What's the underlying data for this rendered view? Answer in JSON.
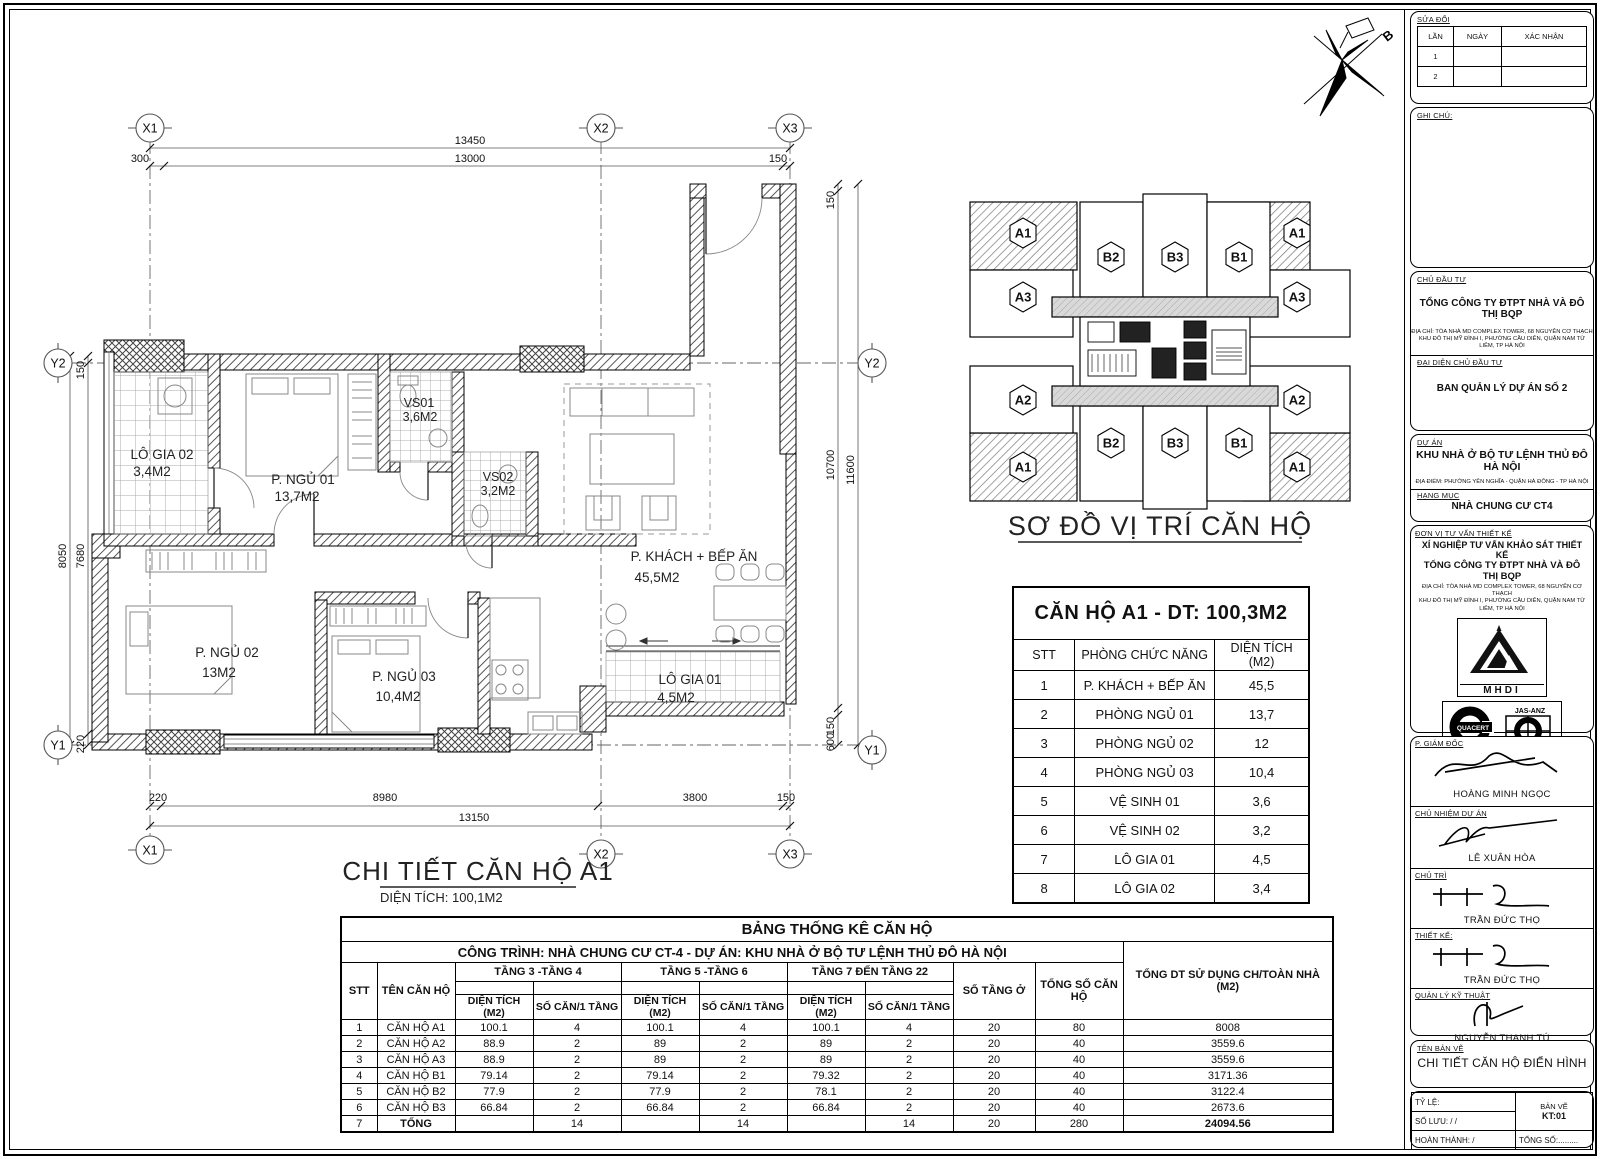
{
  "north_arrow": {
    "label": "B"
  },
  "plan": {
    "title": "CHI TIẾT CĂN HỘ A1",
    "subtitle": "DIỆN TÍCH: 100,1M2",
    "grid": {
      "x1": "X1",
      "x2": "X2",
      "x3": "X3",
      "y1": "Y1",
      "y2": "Y2"
    },
    "rooms": {
      "lo_gia_02": {
        "name": "LÔ GIA 02",
        "area": "3,4M2"
      },
      "p_ngu_01": {
        "name": "P. NGỦ 01",
        "area": "13,7M2"
      },
      "vs01": {
        "name": "VS01",
        "area": "3,6M2"
      },
      "vs02": {
        "name": "VS02",
        "area": "3,2M2"
      },
      "p_khach": {
        "name": "P. KHÁCH + BẾP ĂN",
        "area": "45,5M2"
      },
      "p_ngu_02": {
        "name": "P. NGỦ 02",
        "area": "13M2"
      },
      "p_ngu_03": {
        "name": "P. NGỦ 03",
        "area": "10,4M2"
      },
      "lo_gia_01": {
        "name": "LÔ GIA 01",
        "area": "4,5M2"
      }
    },
    "dims": {
      "top_overall": "13450",
      "top_main": "13000",
      "top_left": "300",
      "top_right": "150",
      "left_overall": "8050",
      "left_main": "7680",
      "left_top": "150",
      "left_bottom": "220",
      "bottom_left": "220",
      "bottom_main": "8980",
      "bottom_right": "3800",
      "bottom_end": "150",
      "bottom_overall": "13150",
      "right_top": "150",
      "right_main": "10700",
      "right_overall": "11600",
      "right_bottom_150": "150",
      "right_bottom_600": "600"
    }
  },
  "key_plan": {
    "title": "SƠ ĐỒ VỊ TRÍ CĂN HỘ",
    "units": {
      "tl": "A1",
      "tr": "A1",
      "bl": "A1",
      "br": "A1",
      "left_a3": "A3",
      "right_a3": "A3",
      "left_a2": "A2",
      "right_a2": "A2",
      "top_b2": "B2",
      "top_b3": "B3",
      "top_b1": "B1",
      "bottom_b2": "B2",
      "bottom_b3": "B3",
      "bottom_b1": "B1"
    }
  },
  "apartment_table": {
    "title": "CĂN HỘ A1 - DT: 100,3M2",
    "headers": [
      "STT",
      "PHÒNG CHỨC NĂNG",
      "DIỆN TÍCH (M2)"
    ],
    "rows": [
      [
        "1",
        "P. KHÁCH + BẾP ĂN",
        "45,5"
      ],
      [
        "2",
        "PHÒNG NGỦ 01",
        "13,7"
      ],
      [
        "3",
        "PHÒNG NGỦ 02",
        "12"
      ],
      [
        "4",
        "PHÒNG NGỦ 03",
        "10,4"
      ],
      [
        "5",
        "VỆ SINH 01",
        "3,6"
      ],
      [
        "6",
        "VỆ SINH 02",
        "3,2"
      ],
      [
        "7",
        "LÔ GIA 01",
        "4,5"
      ],
      [
        "8",
        "LÔ GIA 02",
        "3,4"
      ]
    ]
  },
  "stats_table": {
    "title": "BẢNG THỐNG KÊ CĂN HỘ",
    "subtitle": "CÔNG TRÌNH: NHÀ CHUNG CƯ CT-4 - DỰ ÁN: KHU NHÀ Ở BỘ TƯ LỆNH THỦ ĐÔ HÀ NỘI",
    "col_stt": "STT",
    "col_ten": "TÊN CĂN HỘ",
    "groups": [
      "TẦNG 3 -TẦNG 4",
      "TẦNG 5 -TẦNG 6",
      "TẦNG 7 ĐẾN TẦNG 22"
    ],
    "sub_dien_tich": "DIỆN TÍCH (M2)",
    "sub_so_can": "SỐ CĂN/1 TẦNG",
    "col_so_tang": "SỐ TẦNG Ở",
    "col_tong_so": "TỔNG SỐ CĂN HỘ",
    "col_tong_dt": "TỔNG DT SỬ DỤNG CH/TOÀN NHÀ (M2)",
    "rows": [
      [
        "1",
        "CĂN HỘ A1",
        "100.1",
        "4",
        "100.1",
        "4",
        "100.1",
        "4",
        "20",
        "80",
        "8008"
      ],
      [
        "2",
        "CĂN HỘ A2",
        "88.9",
        "2",
        "89",
        "2",
        "89",
        "2",
        "20",
        "40",
        "3559.6"
      ],
      [
        "3",
        "CĂN HỘ A3",
        "88.9",
        "2",
        "89",
        "2",
        "89",
        "2",
        "20",
        "40",
        "3559.6"
      ],
      [
        "4",
        "CĂN HỘ B1",
        "79.14",
        "2",
        "79.14",
        "2",
        "79.32",
        "2",
        "20",
        "40",
        "3171.36"
      ],
      [
        "5",
        "CĂN HỘ B2",
        "77.9",
        "2",
        "77.9",
        "2",
        "78.1",
        "2",
        "20",
        "40",
        "3122.4"
      ],
      [
        "6",
        "CĂN HỘ B3",
        "66.84",
        "2",
        "66.84",
        "2",
        "66.84",
        "2",
        "20",
        "40",
        "2673.6"
      ],
      [
        "7",
        "TỔNG",
        "",
        "14",
        "",
        "14",
        "",
        "14",
        "20",
        "280",
        "24094.56"
      ]
    ]
  },
  "title_block": {
    "revision": {
      "title": "SỬA ĐỔI",
      "cols": [
        "LẦN",
        "NGÀY",
        "XÁC NHẬN"
      ],
      "rows": [
        [
          "1",
          "",
          ""
        ],
        [
          "2",
          "",
          ""
        ]
      ]
    },
    "notes_label": "GHI CHÚ:",
    "investor_label": "CHỦ ĐẦU TƯ",
    "investor": "TỔNG CÔNG TY ĐTPT NHÀ VÀ ĐÔ THỊ BQP",
    "investor_addr1": "ĐỊA CHỈ: TÒA NHÀ MD COMPLEX TOWER, 68 NGUYỄN CƠ THẠCH",
    "investor_addr2": "KHU ĐÔ THỊ MỸ ĐÌNH I, PHƯỜNG CẦU DIỄN, QUẬN NAM TỪ LIÊM, TP HÀ NỘI",
    "rep_label": "ĐẠI DIỆN CHỦ ĐẦU TƯ",
    "rep": "BAN QUẢN LÝ DỰ ÁN SỐ 2",
    "project_label": "DỰ ÁN",
    "project": "KHU NHÀ Ở BỘ TƯ LỆNH THỦ ĐÔ HÀ NỘI",
    "project_addr": "ĐỊA ĐIỂM: PHƯỜNG YÊN NGHĨA - QUẬN HÀ ĐÔNG - TP HÀ NỘI",
    "category_label": "HẠNG MỤC",
    "category": "NHÀ CHUNG CƯ CT4",
    "consultant_label": "ĐƠN VỊ TƯ VẤN THIẾT KẾ",
    "consultant1": "XÍ NGHIỆP TƯ VẤN KHẢO SÁT THIẾT KẾ",
    "consultant2": "TỔNG CÔNG TY ĐTPT NHÀ VÀ ĐÔ THỊ BQP",
    "consultant_addr1": "ĐỊA CHỈ: TÒA NHÀ MD COMPLEX TOWER, 68 NGUYỄN CƠ THẠCH",
    "consultant_addr2": "KHU ĐÔ THỊ MỸ ĐÌNH I, PHƯỜNG CẦU DIỄN, QUẬN NAM TỪ LIÊM, TP HÀ NỘI",
    "mhdi": "MHDI",
    "quacert": "QUACERT",
    "jas": "JAS-ANZ",
    "iso": "ISO 9001:2015",
    "director_label": "P. GIÁM ĐỐC",
    "director": "HOÀNG MINH NGỌC",
    "manager_label": "CHỦ NHIỆM DỰ ÁN",
    "manager": "LÊ XUÂN HÒA",
    "lead_label": "CHỦ TRÌ",
    "lead": "TRẦN ĐỨC THỌ",
    "designer_label": "THIẾT KẾ:",
    "designer": "TRẦN ĐỨC THỌ",
    "tech_label": "QUẢN LÝ KỸ THUẬT",
    "tech": "NGUYỄN THANH TÚ",
    "drawing_name_label": "TÊN BẢN VẼ",
    "drawing_name": "CHI TIẾT CĂN HỘ ĐIỂN HÌNH",
    "scale_label": "TỶ LỆ:",
    "sheet_label": "BẢN VẼ",
    "sheet_no": "KT:01",
    "archive_label": "SỐ LƯU:    /    /",
    "complete_label": "HOÀN THÀNH:    /",
    "total_label": "TỔNG SỐ:........."
  }
}
